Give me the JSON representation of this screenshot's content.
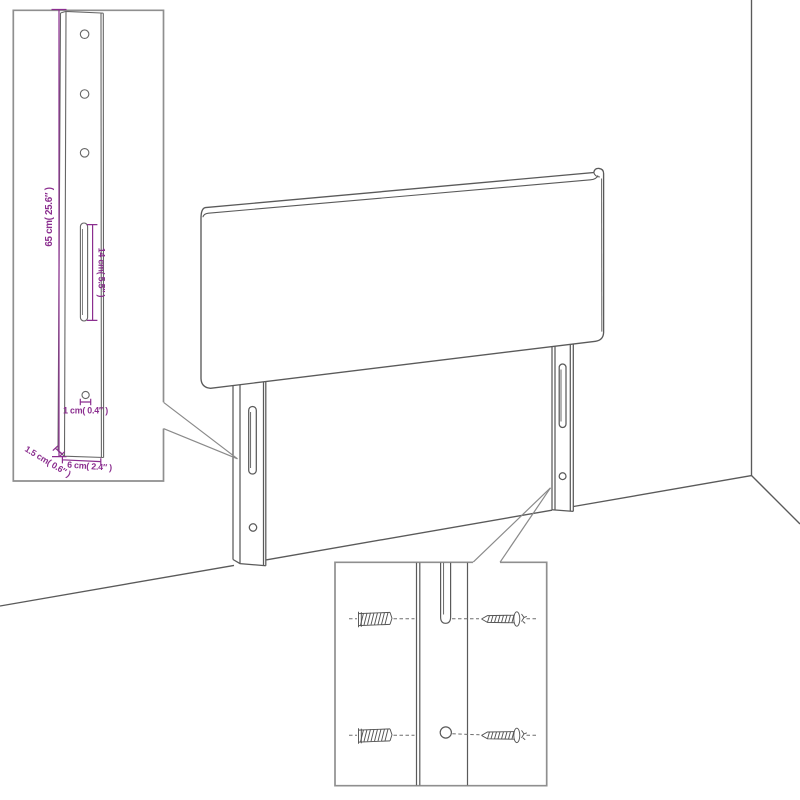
{
  "colors": {
    "background": "#ffffff",
    "line_art": "#5a5a5a",
    "inset_border": "#8f8f8f",
    "callout_line": "#8a8a8a",
    "dimension_magenta": "#8b2e8f"
  },
  "main_view": {
    "subject": "upholstered headboard with two slotted wall-mount legs shown against a room corner"
  },
  "leg_detail_inset": {
    "dim_height": "65 cm( 25.6″ )",
    "dim_slot_length": "14 cm( 5.5″ )",
    "dim_hole_diameter": "1 cm( 0.4″ )",
    "dim_leg_width": "6 cm( 2.4″ )",
    "dim_leg_thickness": "1.5 cm( 0.6″ )",
    "top_hole_count": 3
  },
  "mounting_detail_inset": {
    "wall_plug_count": 2,
    "screw_count": 2,
    "slot_count": 1,
    "hole_count": 1
  }
}
